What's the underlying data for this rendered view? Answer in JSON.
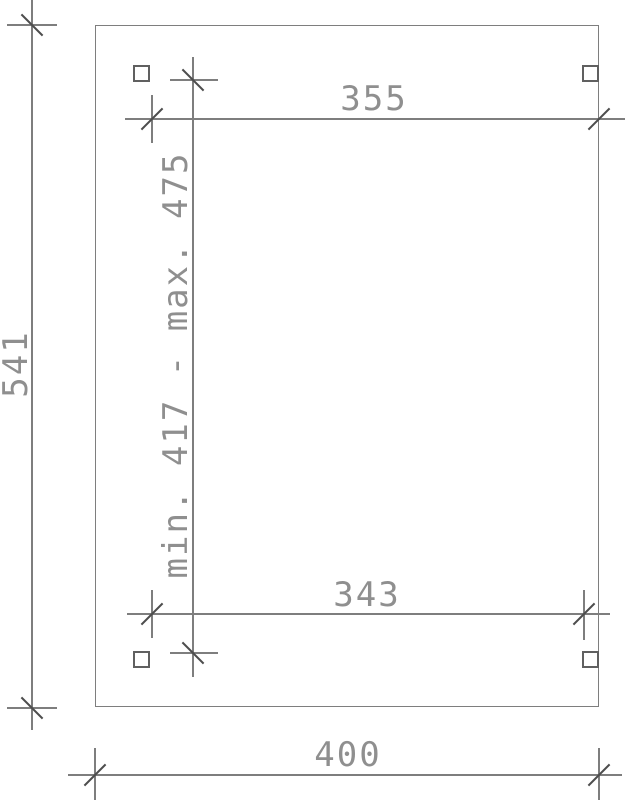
{
  "drawing": {
    "type": "technical-dimension-plan",
    "background_color": "#ffffff",
    "line_color": "#7e7e7e",
    "tick_color": "#4d4d4d",
    "text_color": "#8f8f8f",
    "labels": {
      "outer_height": "541",
      "outer_width": "400",
      "top_span": "355",
      "bottom_span": "343",
      "inner_height_range": "min. 417 - max. 475"
    }
  }
}
